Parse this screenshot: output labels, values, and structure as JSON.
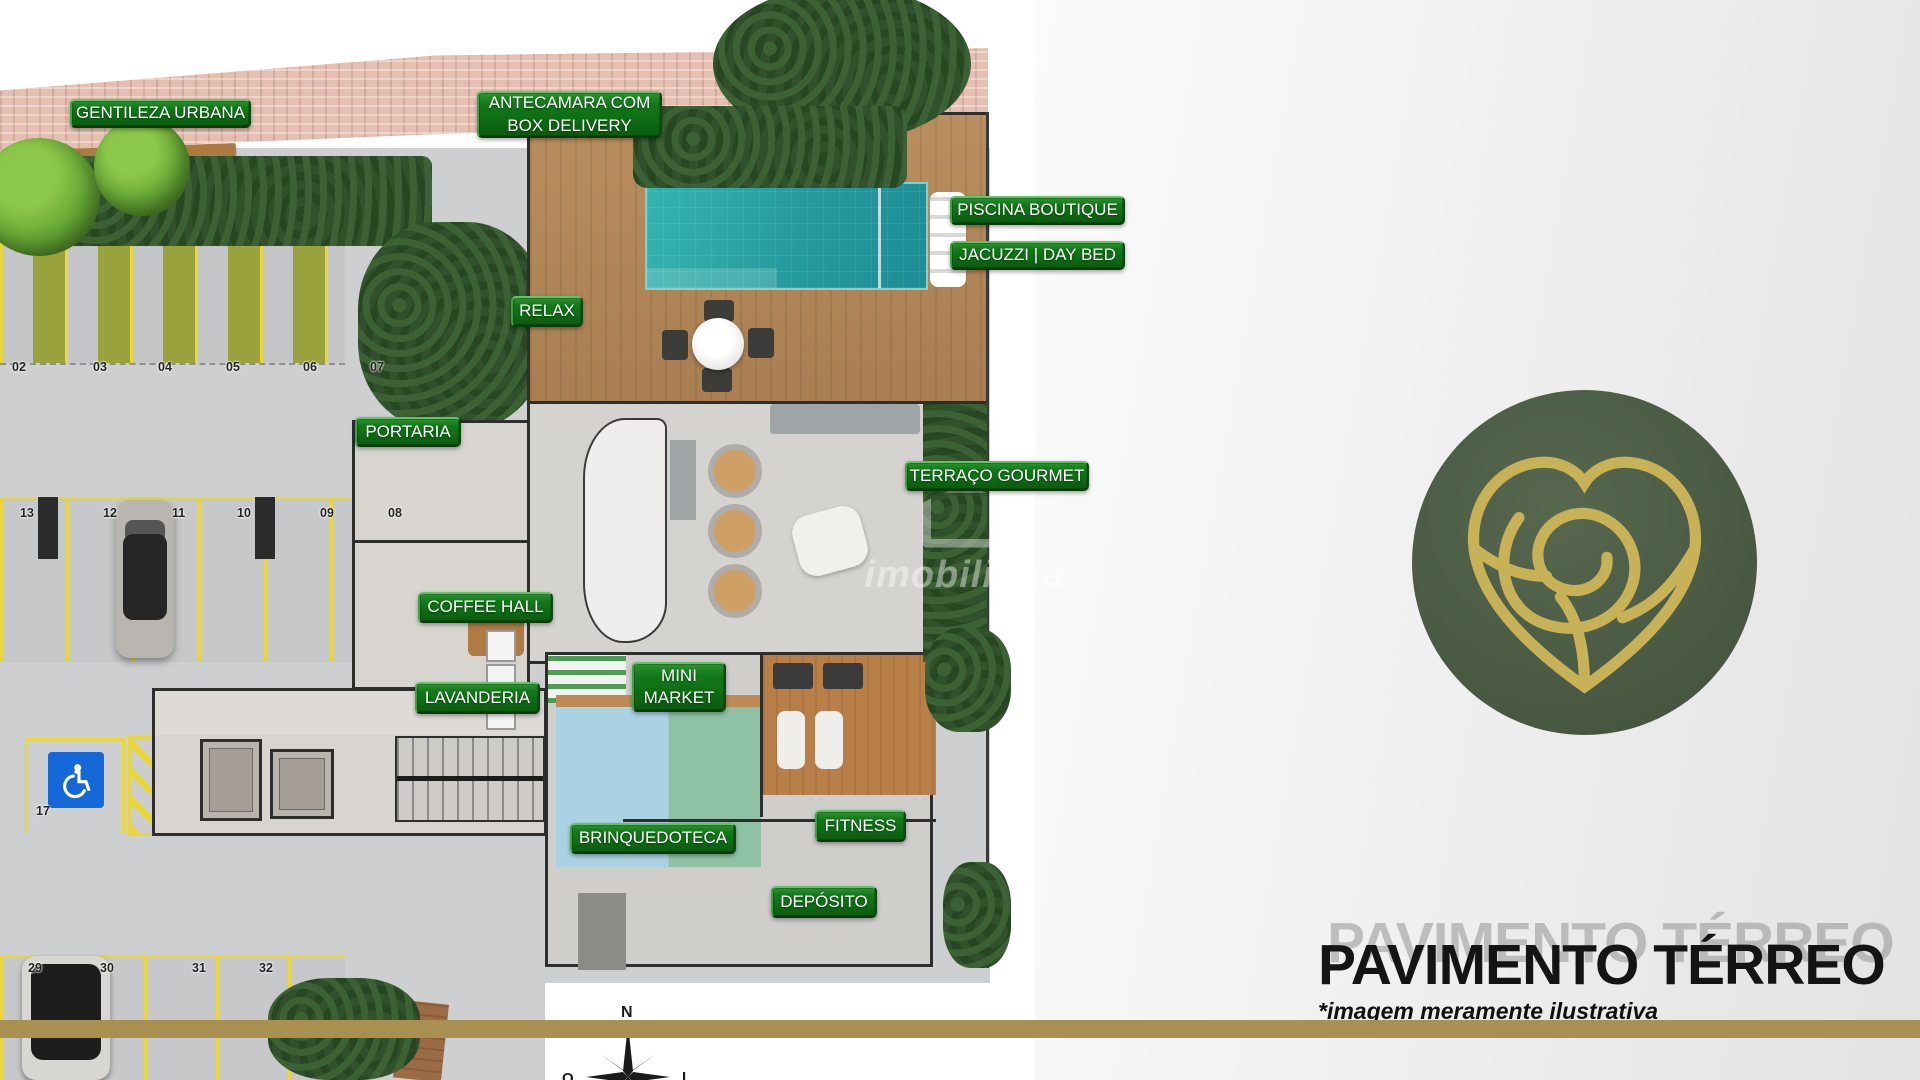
{
  "floor_plan": {
    "area_labels": [
      {
        "id": "gentileza-urbana",
        "lines": [
          "GENTILEZA URBANA"
        ],
        "x": 70,
        "y": 99,
        "w": 181,
        "h": 29
      },
      {
        "id": "antecamara-box-delivery",
        "lines": [
          "ANTECAMARA COM",
          "BOX DELIVERY"
        ],
        "x": 477,
        "y": 91,
        "w": 185,
        "h": 47
      },
      {
        "id": "piscina-boutique",
        "lines": [
          "PISCINA BOUTIQUE"
        ],
        "x": 950,
        "y": 196,
        "w": 175,
        "h": 29
      },
      {
        "id": "jacuzzi-day-bed",
        "lines": [
          "JACUZZI | DAY BED"
        ],
        "x": 950,
        "y": 241,
        "w": 175,
        "h": 29
      },
      {
        "id": "relax",
        "lines": [
          "RELAX"
        ],
        "x": 511,
        "y": 296,
        "w": 72,
        "h": 31
      },
      {
        "id": "portaria",
        "lines": [
          "PORTARIA"
        ],
        "x": 355,
        "y": 417,
        "w": 106,
        "h": 30
      },
      {
        "id": "terraco-gourmet",
        "lines": [
          "TERRAÇO GOURMET"
        ],
        "x": 905,
        "y": 461,
        "w": 184,
        "h": 30
      },
      {
        "id": "coffee-hall",
        "lines": [
          "COFFEE HALL"
        ],
        "x": 418,
        "y": 592,
        "w": 135,
        "h": 31
      },
      {
        "id": "mini-market",
        "lines": [
          "MINI",
          "MARKET"
        ],
        "x": 632,
        "y": 662,
        "w": 94,
        "h": 50
      },
      {
        "id": "lavanderia",
        "lines": [
          "LAVANDERIA"
        ],
        "x": 415,
        "y": 682,
        "w": 125,
        "h": 32
      },
      {
        "id": "brinquedoteca",
        "lines": [
          "BRINQUEDOTECA"
        ],
        "x": 570,
        "y": 823,
        "w": 166,
        "h": 31
      },
      {
        "id": "fitness",
        "lines": [
          "FITNESS"
        ],
        "x": 815,
        "y": 810,
        "w": 91,
        "h": 32
      },
      {
        "id": "deposito",
        "lines": [
          "DEPÓSITO"
        ],
        "x": 771,
        "y": 886,
        "w": 106,
        "h": 32
      }
    ],
    "parking_spots": [
      {
        "n": "02",
        "x": 12,
        "y": 360
      },
      {
        "n": "03",
        "x": 93,
        "y": 360
      },
      {
        "n": "04",
        "x": 158,
        "y": 360
      },
      {
        "n": "05",
        "x": 226,
        "y": 360
      },
      {
        "n": "06",
        "x": 303,
        "y": 360
      },
      {
        "n": "07",
        "x": 370,
        "y": 360
      },
      {
        "n": "13",
        "x": 20,
        "y": 506
      },
      {
        "n": "12",
        "x": 103,
        "y": 506
      },
      {
        "n": "11",
        "x": 172,
        "y": 506
      },
      {
        "n": "10",
        "x": 237,
        "y": 506
      },
      {
        "n": "09",
        "x": 320,
        "y": 506
      },
      {
        "n": "08",
        "x": 388,
        "y": 506
      },
      {
        "n": "17",
        "x": 36,
        "y": 804
      },
      {
        "n": "29",
        "x": 28,
        "y": 961
      },
      {
        "n": "30",
        "x": 100,
        "y": 961
      },
      {
        "n": "31",
        "x": 192,
        "y": 961
      },
      {
        "n": "32",
        "x": 259,
        "y": 961
      }
    ],
    "compass": {
      "north": "N",
      "west": "O",
      "east": "L"
    },
    "watermark": "imobiliária"
  },
  "side_panel": {
    "title": "PAVIMENTO TÉRREO",
    "disclaimer": "*imagem meramente ilustrativa",
    "logo": "rose-heart-monogram"
  },
  "colors": {
    "label_green": "#0e6d14",
    "gold_bar": "#aa9050",
    "logo_green": "#4c5d49",
    "logo_gold": "#c8b257",
    "pool_teal": "#259a9e",
    "accessible_blue": "#1468d8",
    "parking_line_yellow": "#e8d63b"
  }
}
